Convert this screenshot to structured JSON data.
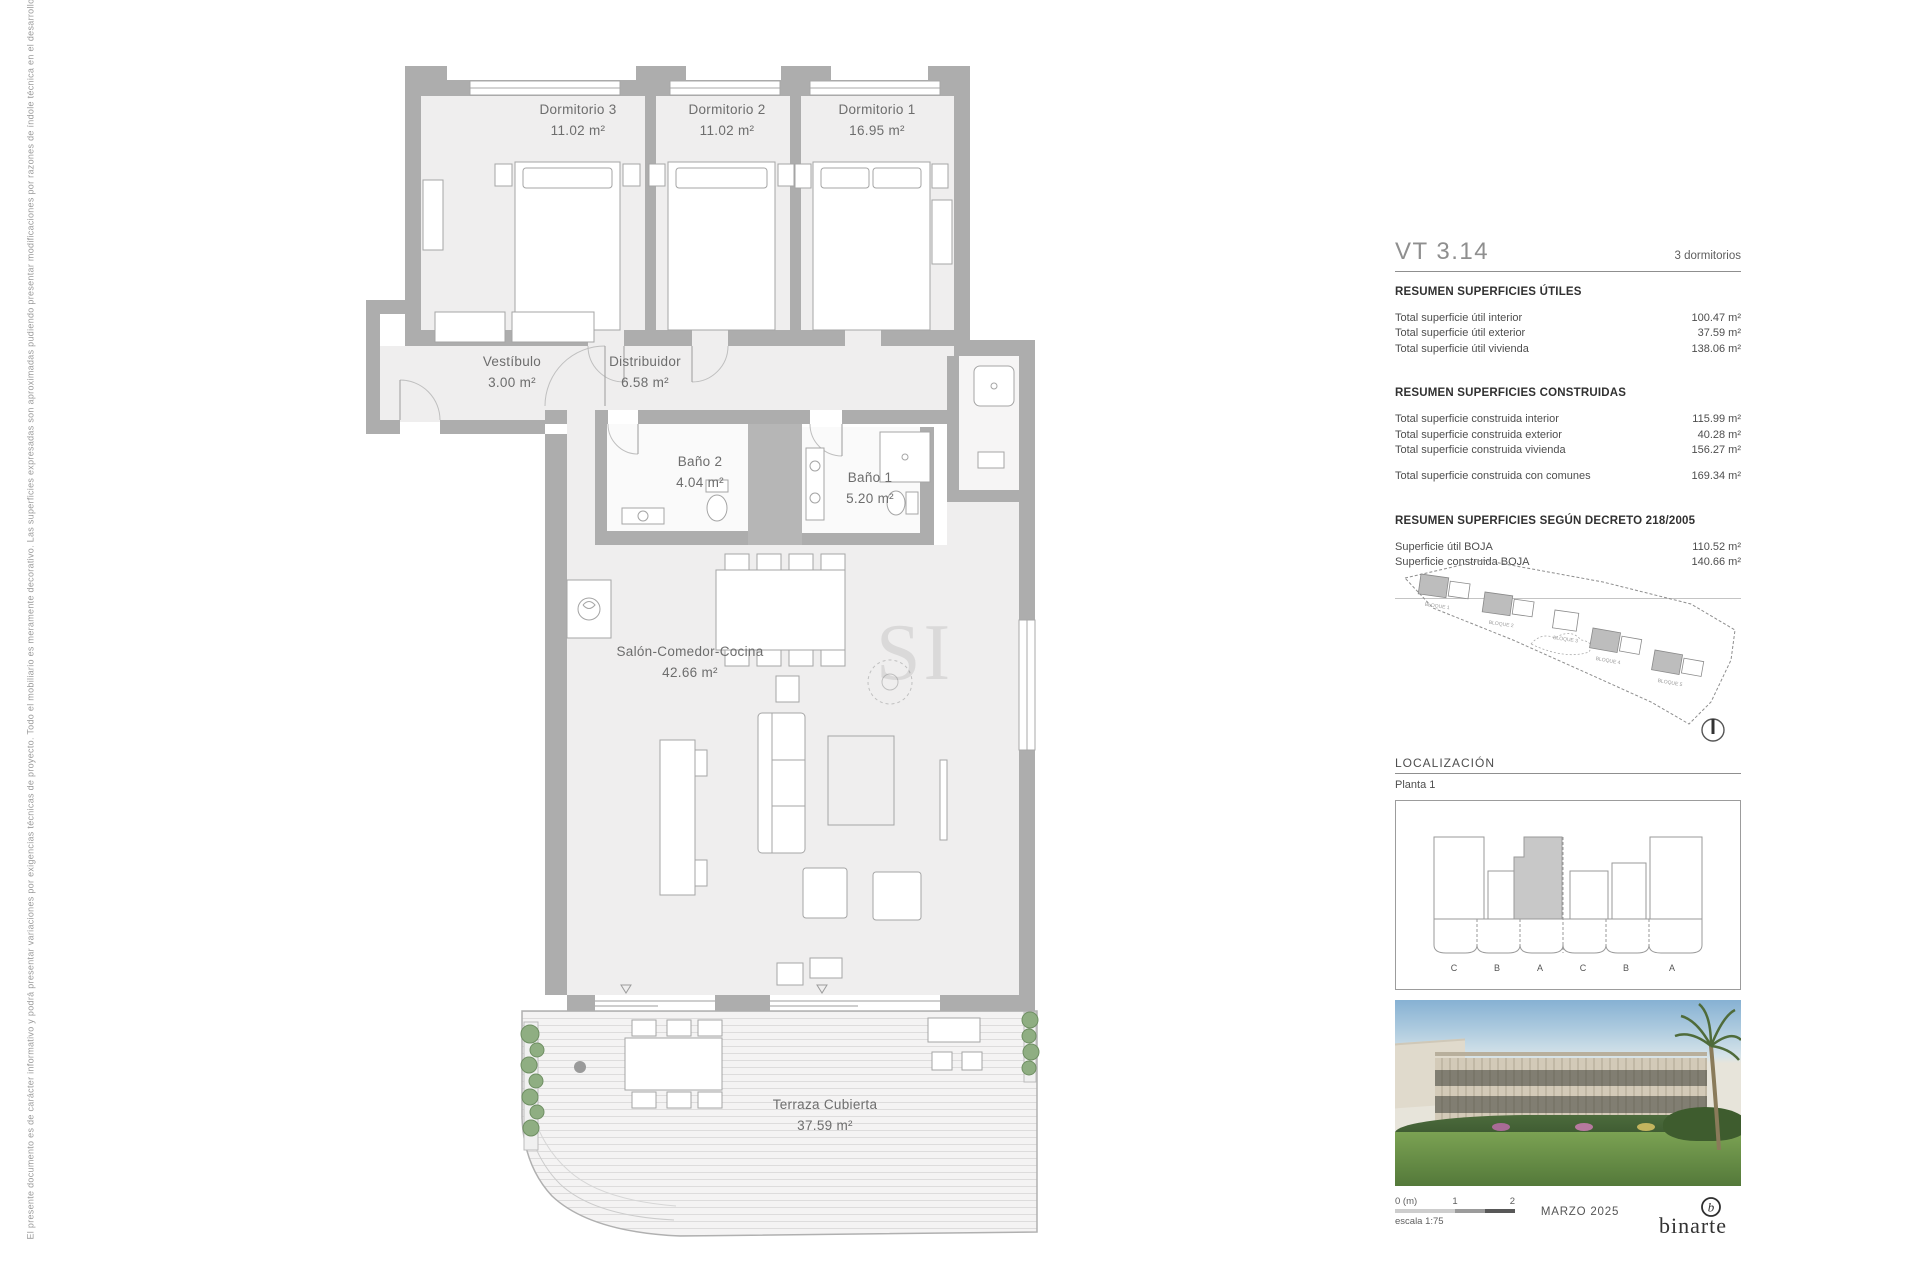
{
  "document": {
    "disclaimer": "El presente documento es de carácter informativo y podrá presentar variaciones por exigencias técnicas de proyecto. Todo el mobiliario es meramente decorativo. Las superficies expresadas son aproximadas pudiendo presentar modificaciones por razones de índole técnica en el desarrollo de ejecución de las obras.",
    "watermark": "SI"
  },
  "plan": {
    "rooms": [
      {
        "name": "Dormitorio 3",
        "area": "11.02 m²"
      },
      {
        "name": "Dormitorio 2",
        "area": "11.02 m²"
      },
      {
        "name": "Dormitorio 1",
        "area": "16.95 m²"
      },
      {
        "name": "Vestíbulo",
        "area": "3.00 m²"
      },
      {
        "name": "Distribuidor",
        "area": "6.58 m²"
      },
      {
        "name": "Baño 2",
        "area": "4.04 m²"
      },
      {
        "name": "Baño 1",
        "area": "5.20 m²"
      },
      {
        "name": "Salón-Comedor-Cocina",
        "area": "42.66 m²"
      },
      {
        "name": "Terraza Cubierta",
        "area": "37.59 m²"
      }
    ]
  },
  "panel": {
    "unit_code": "VT 3.14",
    "unit_type": "3 dormitorios",
    "sections": [
      {
        "title": "RESUMEN SUPERFICIES ÚTILES",
        "rows": [
          {
            "label": "Total superficie útil interior",
            "value": "100.47 m²"
          },
          {
            "label": "Total superficie útil exterior",
            "value": "37.59 m²"
          },
          {
            "label": "Total superficie útil vivienda",
            "value": "138.06 m²"
          }
        ]
      },
      {
        "title": "RESUMEN SUPERFICIES CONSTRUIDAS",
        "rows": [
          {
            "label": "Total superficie construida interior",
            "value": "115.99 m²"
          },
          {
            "label": "Total superficie construida exterior",
            "value": "40.28 m²"
          },
          {
            "label": "Total superficie construida vivienda",
            "value": "156.27 m²"
          }
        ],
        "total_row": {
          "label": "Total superficie construida con comunes",
          "value": "169.34 m²"
        }
      },
      {
        "title": "RESUMEN SUPERFICIES SEGÚN DECRETO 218/2005",
        "rows": [
          {
            "label": "Superficie útil BOJA",
            "value": "110.52 m²"
          },
          {
            "label": "Superficie construida BOJA",
            "value": "140.66 m²"
          }
        ]
      }
    ],
    "site_plan": {
      "blocks": [
        "BLOQUE 1",
        "BLOQUE 2",
        "BLOQUE 3",
        "BLOQUE 4",
        "BLOQUE 5"
      ]
    },
    "localizacion_label": "LOCALIZACIÓN",
    "planta_label": "Planta 1",
    "planta_diagram": {
      "letters": [
        "C",
        "B",
        "A",
        "C",
        "B",
        "A"
      ]
    },
    "footer": {
      "scale_zero": "0 (m)",
      "scale_one": "1",
      "scale_two": "2",
      "scale_text": "escala 1:75",
      "date": "MARZO 2025",
      "logo_text": "binarte"
    }
  }
}
